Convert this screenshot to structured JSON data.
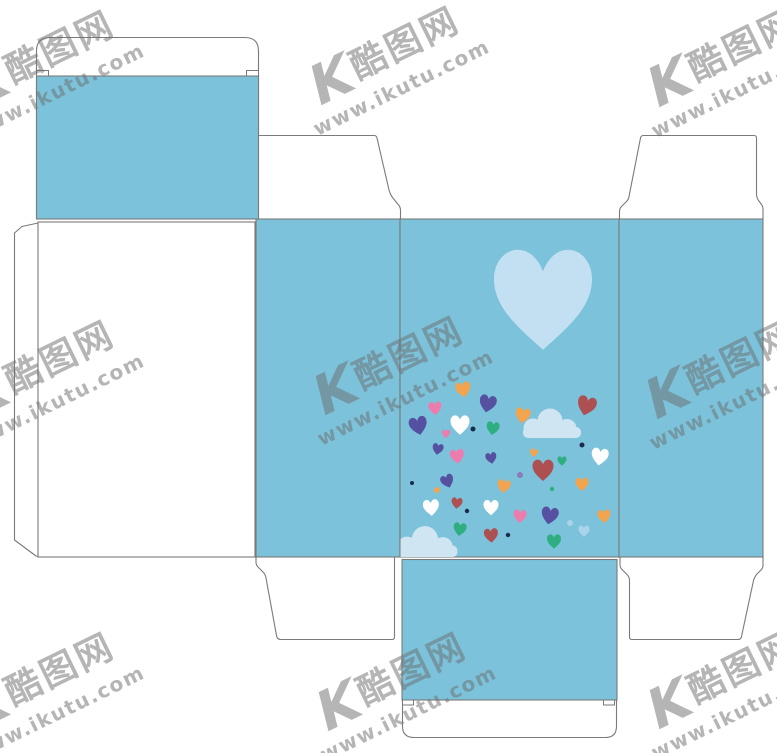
{
  "canvas": {
    "width": 777,
    "height": 753,
    "background": "#ffffff"
  },
  "watermark": {
    "logo_text": "K",
    "site_name": "酷图网",
    "site_url": "www.ikutu.com",
    "color": "#6e6e6e",
    "angle_deg": -26,
    "tiles": [
      {
        "x": 45,
        "y": 68
      },
      {
        "x": 390,
        "y": 64
      },
      {
        "x": 728,
        "y": 66
      },
      {
        "x": 45,
        "y": 378
      },
      {
        "x": 394,
        "y": 374
      },
      {
        "x": 726,
        "y": 378
      },
      {
        "x": 45,
        "y": 690
      },
      {
        "x": 397,
        "y": 690
      },
      {
        "x": 728,
        "y": 688
      }
    ]
  },
  "palette": {
    "panel_blue": "#7cc2db",
    "outline_gray": "#7a7a7a",
    "heart_lightblue": "#c3e0f3",
    "cloud_blue": "#d0e5f2",
    "white": "#ffffff",
    "purple": "#5550a0",
    "pink": "#ec7cad",
    "orange": "#f2a44f",
    "green": "#2fae81",
    "red": "#ac5052",
    "paleblue": "#aad4ea",
    "navy": "#1c2b4a",
    "violet": "#8a7ab8"
  },
  "design": {
    "big_heart": {
      "x": 543,
      "y": 289,
      "s": 98,
      "r": 0,
      "c": "heart_lightblue"
    },
    "clouds": [
      {
        "x": 552,
        "y": 426,
        "s": 1.0
      },
      {
        "x": 427,
        "y": 544.5,
        "s": 1.05
      }
    ],
    "hearts": [
      {
        "x": 463,
        "y": 388,
        "s": 15,
        "r": -10,
        "c": "orange"
      },
      {
        "x": 488,
        "y": 402,
        "s": 17,
        "r": 12,
        "c": "purple"
      },
      {
        "x": 587,
        "y": 404,
        "s": 19,
        "r": 15,
        "c": "red"
      },
      {
        "x": 435,
        "y": 407,
        "s": 13,
        "r": -5,
        "c": "pink"
      },
      {
        "x": 418,
        "y": 424,
        "s": 18,
        "r": -12,
        "c": "purple"
      },
      {
        "x": 460,
        "y": 423,
        "s": 19,
        "r": 0,
        "c": "white"
      },
      {
        "x": 493,
        "y": 427,
        "s": 13,
        "r": 8,
        "c": "green"
      },
      {
        "x": 523,
        "y": 414,
        "s": 15,
        "r": 10,
        "c": "orange"
      },
      {
        "x": 438,
        "y": 448,
        "s": 11,
        "r": 10,
        "c": "purple"
      },
      {
        "x": 446,
        "y": 433,
        "s": 8,
        "r": 0,
        "c": "pink"
      },
      {
        "x": 457,
        "y": 455,
        "s": 14,
        "r": -8,
        "c": "pink"
      },
      {
        "x": 491,
        "y": 457,
        "s": 11,
        "r": -10,
        "c": "purple"
      },
      {
        "x": 534,
        "y": 452,
        "s": 8,
        "r": 15,
        "c": "orange"
      },
      {
        "x": 562,
        "y": 460,
        "s": 9,
        "r": 0,
        "c": "green"
      },
      {
        "x": 600,
        "y": 455,
        "s": 17,
        "r": 8,
        "c": "white"
      },
      {
        "x": 543,
        "y": 468,
        "s": 21,
        "r": 0,
        "c": "red"
      },
      {
        "x": 447,
        "y": 480,
        "s": 13,
        "r": -20,
        "c": "purple"
      },
      {
        "x": 504,
        "y": 485,
        "s": 13,
        "r": 10,
        "c": "orange"
      },
      {
        "x": 582,
        "y": 483,
        "s": 13,
        "r": 0,
        "c": "orange"
      },
      {
        "x": 431,
        "y": 506,
        "s": 16,
        "r": -5,
        "c": "white"
      },
      {
        "x": 457,
        "y": 502,
        "s": 11,
        "r": 5,
        "c": "red"
      },
      {
        "x": 491,
        "y": 506,
        "s": 15,
        "r": 0,
        "c": "white"
      },
      {
        "x": 520,
        "y": 515,
        "s": 13,
        "r": 5,
        "c": "pink"
      },
      {
        "x": 550,
        "y": 514,
        "s": 17,
        "r": 10,
        "c": "purple"
      },
      {
        "x": 604,
        "y": 515,
        "s": 13,
        "r": -5,
        "c": "orange"
      },
      {
        "x": 460,
        "y": 528,
        "s": 13,
        "r": 8,
        "c": "green"
      },
      {
        "x": 491,
        "y": 534,
        "s": 14,
        "r": -5,
        "c": "red"
      },
      {
        "x": 554,
        "y": 540,
        "s": 14,
        "r": 0,
        "c": "green"
      },
      {
        "x": 584,
        "y": 530,
        "s": 11,
        "r": 0,
        "c": "paleblue"
      }
    ],
    "dots": [
      {
        "x": 473,
        "y": 429,
        "r": 2.5,
        "c": "navy"
      },
      {
        "x": 437,
        "y": 490,
        "r": 3,
        "c": "orange"
      },
      {
        "x": 467,
        "y": 511,
        "r": 2.2,
        "c": "navy"
      },
      {
        "x": 520,
        "y": 475,
        "r": 3,
        "c": "violet"
      },
      {
        "x": 508,
        "y": 535,
        "r": 2.2,
        "c": "navy"
      },
      {
        "x": 552,
        "y": 489,
        "r": 2.2,
        "c": "green"
      },
      {
        "x": 582,
        "y": 445,
        "r": 2.5,
        "c": "navy"
      },
      {
        "x": 412,
        "y": 483,
        "r": 2,
        "c": "navy"
      },
      {
        "x": 570,
        "y": 523,
        "r": 3,
        "c": "paleblue"
      }
    ]
  }
}
